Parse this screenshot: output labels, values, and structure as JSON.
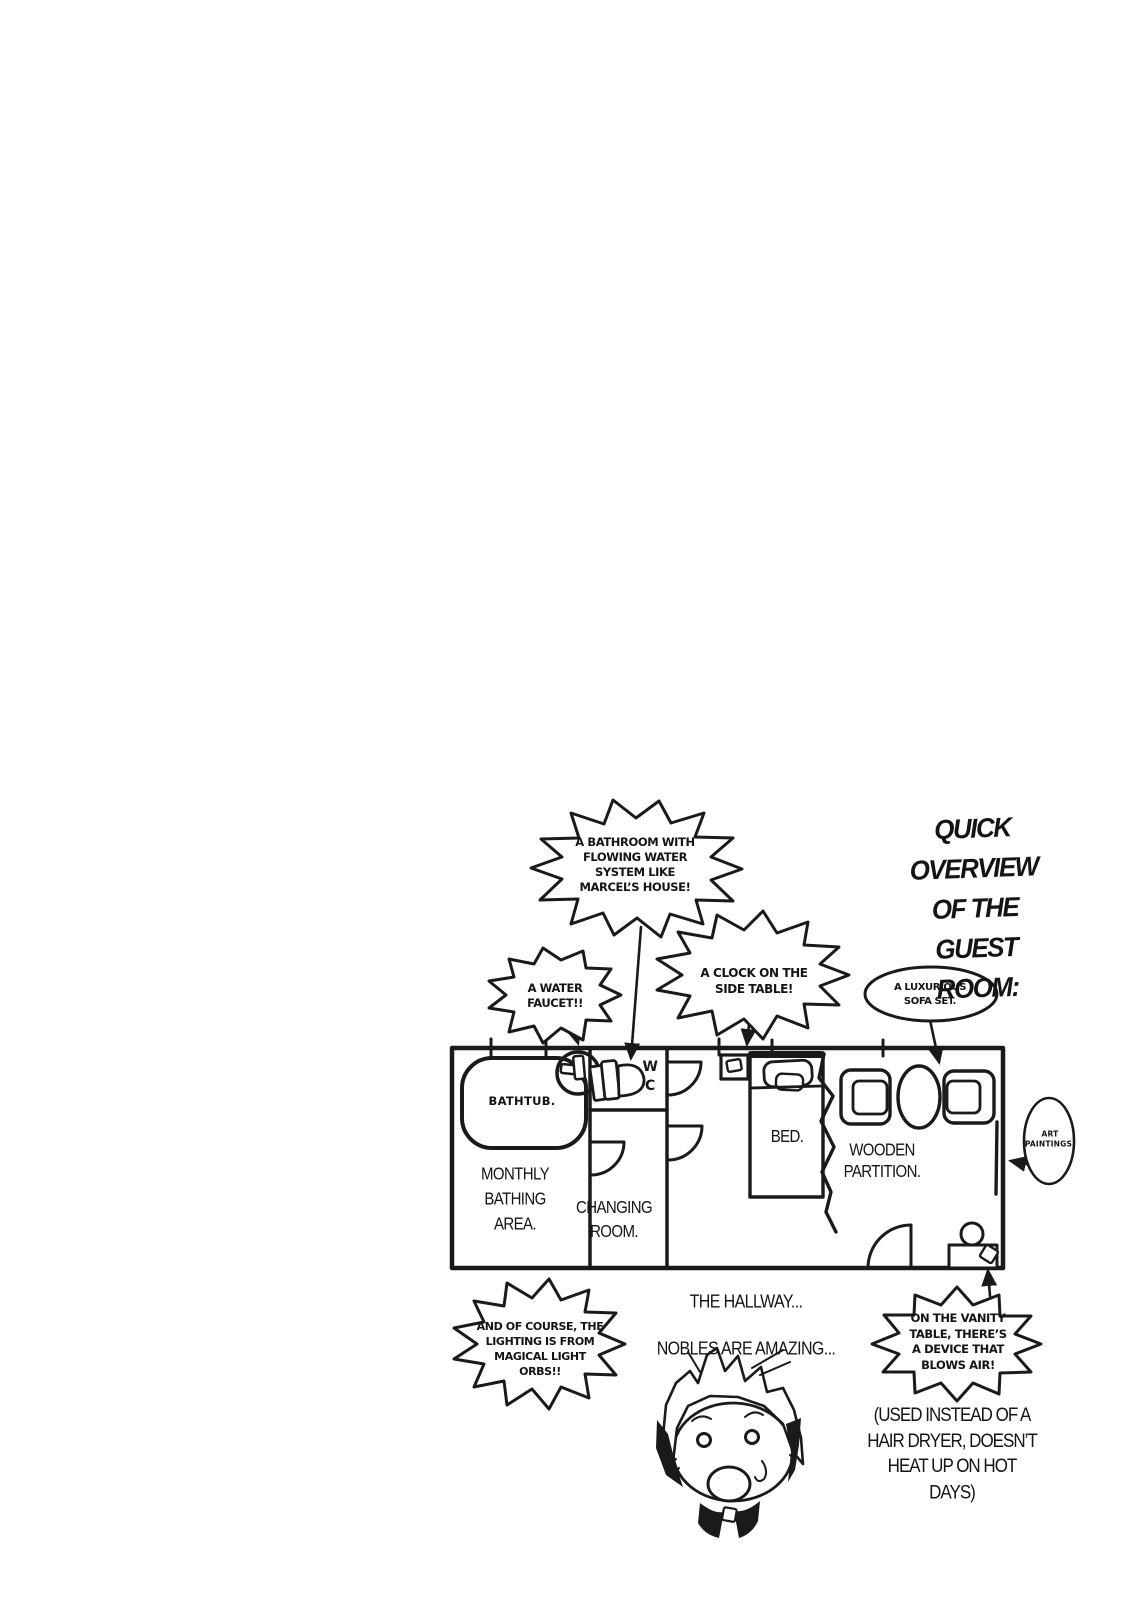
{
  "title": {
    "text": "QUICK OVERVIEW\nOF THE GUEST ROOM:"
  },
  "bubbles": {
    "bathroom": "A BATHROOM WITH\nFLOWING WATER\nSYSTEM LIKE\nMARCEL’S HOUSE!",
    "water_faucet": "A WATER\nFAUCET!!",
    "clock": "A CLOCK ON THE\nSIDE TABLE!",
    "sofa": "A LUXURIOUS\nSOFA SET.",
    "art_paintings": "ART\nPAINTINGS.",
    "lighting": "AND OF COURSE, THE\nLIGHTING IS FROM\nMAGICAL LIGHT\nORBS!!",
    "vanity": "ON THE VANITY\nTABLE, THERE’S\nA DEVICE THAT\nBLOWS AIR!"
  },
  "floor_plan": {
    "bathtub": "BATHTUB.",
    "monthly_bathing_area": "MONTHLY\nBATHING\nAREA.",
    "changing_room": "CHANGING\nROOM.",
    "wc": "W\nC",
    "bed": "BED.",
    "wooden_partition": "WOODEN\nPARTITION."
  },
  "captions": {
    "hallway": "THE HALLWAY...",
    "nobles": "NOBLES ARE AMAZING...",
    "dryer_note": "(USED INSTEAD OF A\nHAIR DRYER, DOESN’T\nHEAT UP ON HOT\nDAYS)"
  },
  "colors": {
    "ink": "#1a1a1a",
    "paper": "#ffffff"
  }
}
